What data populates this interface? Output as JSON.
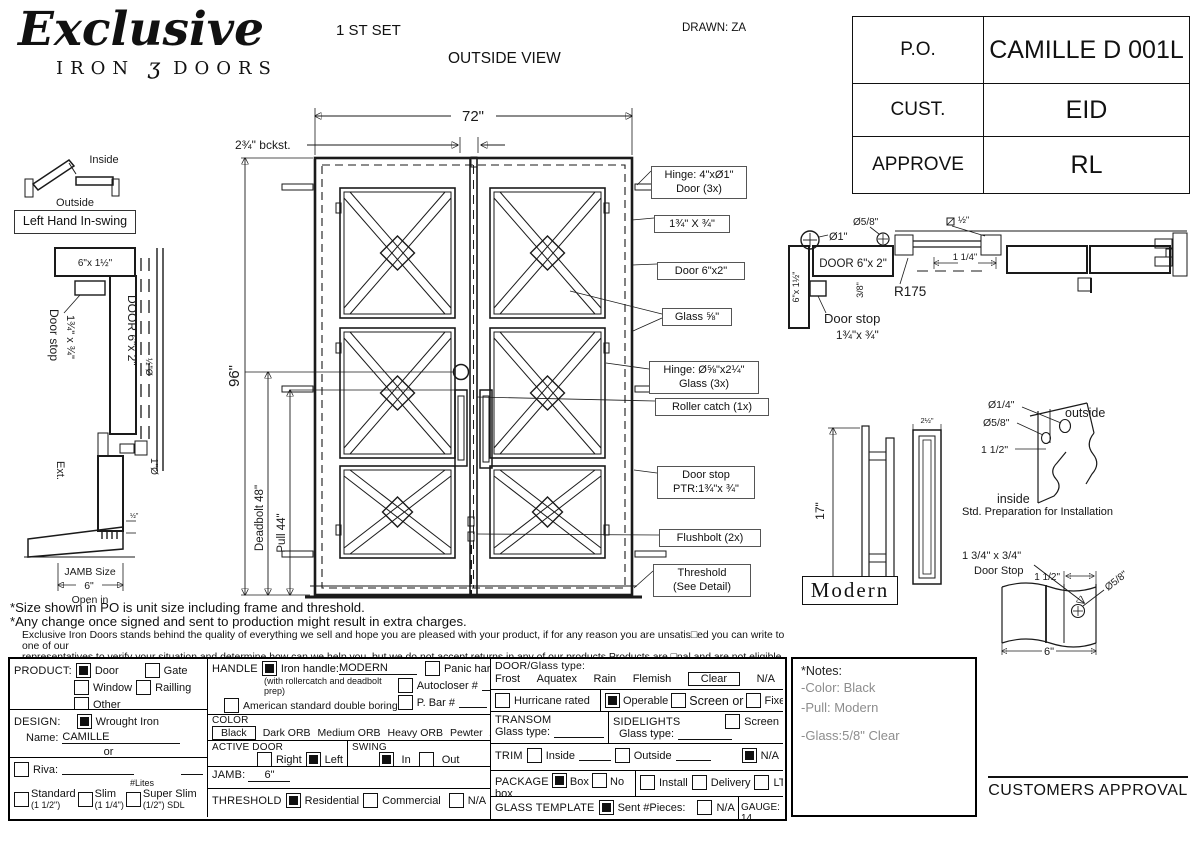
{
  "header": {
    "logo_script": "Exclusive",
    "logo_iron": "IRON",
    "logo_glyph": "ʒ",
    "logo_doors": "DOORS",
    "set_label": "1 ST SET",
    "view_label": "OUTSIDE VIEW",
    "drawn_label": "DRAWN: ZA"
  },
  "approval_table": {
    "rows": [
      {
        "label": "P.O.",
        "value": "CAMILLE D 001L"
      },
      {
        "label": "CUST.",
        "value": "EID"
      },
      {
        "label": "APPROVE",
        "value": "RL"
      }
    ]
  },
  "swing": {
    "inside": "Inside",
    "outside": "Outside",
    "label": "Left Hand In-swing"
  },
  "jamb_detail": {
    "header_dim": "6\"x 1½\"",
    "door_stop_1": "Door stop",
    "door_stop_2": "1¾\" x ¾\"",
    "door_label": "DOOR 6\"x 2\"",
    "half_dia": "½\"Ø",
    "one_dia": "1\"Ø",
    "half_tick": "½\"",
    "ext": "Ext.",
    "jamb_size": "JAMB Size",
    "jamb_width": "6\"",
    "open_in": "Open in"
  },
  "door": {
    "width_dim": "72\"",
    "backset_dim": "2¾\" bckst.",
    "height_dim": "96\"",
    "deadbolt_dim": "Deadbolt 48\"",
    "pull_dim": "Pull 44\"",
    "callouts": [
      {
        "l1": "Hinge: 4\"xØ1\"",
        "l2": "Door (3x)"
      },
      {
        "l1": "1¾\" X ¾\""
      },
      {
        "l1": "Door 6\"x2\""
      },
      {
        "l1": "Glass ⅝\""
      },
      {
        "l1": "Hinge: Ø⅝\"x2¼\"",
        "l2": "Glass (3x)"
      },
      {
        "l1": "Roller catch  (1x)"
      },
      {
        "l1": "Door stop",
        "l2": "PTR:1¾\"x ¾\""
      },
      {
        "l1": "Flushbolt (2x)"
      },
      {
        "l1": "Threshold",
        "l2": "(See Detail)"
      }
    ]
  },
  "head_section": {
    "dia_one": "Ø1\"",
    "dia_58": "Ø5/8\"",
    "sq_half": "½\"",
    "door_label": "DOOR 6\"x 2\"",
    "jamb_dim": "6\"x 1½\"",
    "dim_38": "3/8\"",
    "dim_114": "1 1/4\"",
    "radius": "R175",
    "door_stop_1": "Door stop",
    "door_stop_2": "1¾\"x ¾\""
  },
  "handle_detail": {
    "height_dim": "17\"",
    "width_dim": "2½\"",
    "style": "Modern"
  },
  "corner_detail": {
    "dia_14": "Ø1/4\"",
    "dia_58": "Ø5/8\"",
    "offset": "1 1/2\"",
    "outside": "outside",
    "inside": "inside",
    "caption": "Std. Preparation for Installation"
  },
  "stop_detail": {
    "title_1": "1 3/4\" x 3/4\"",
    "title_2": "Door Stop",
    "dim_top": "1 1/2\"",
    "dia": "Ø5/8\"",
    "dim_bottom": "6\""
  },
  "disclaimer": {
    "line1": "*Size shown in PO is unit size including frame and threshold.",
    "line2": "*Any change once signed and sent to production might result in extra charges.",
    "line3": "Exclusive Iron Doors stands behind the quality of everything we sell and hope you are pleased with your product, if for any reason you are unsatis□ed you can write to one of our",
    "line4": "representatives to verify your situation and determine how can we help you, but we do not accept returns in any of our products.Products are □nal and are not eligible for returns, changes",
    "line5": "or alterations.By signing you agree to our terms and conditions, delivery pdf and forms of payment. *Doors measurements do not include the gaps between jambs"
  },
  "form": {
    "product": {
      "label": "PRODUCT:",
      "door": {
        "label": "Door",
        "checked": "true"
      },
      "gate": {
        "label": "Gate",
        "checked": "false"
      },
      "window": {
        "label": "Window",
        "checked": "false"
      },
      "railing": {
        "label": "Railling",
        "checked": "false"
      },
      "other": {
        "label": "Other",
        "checked": "false"
      }
    },
    "design": {
      "label": "DESIGN:",
      "wrought": {
        "label": "Wrought Iron",
        "checked": "true"
      },
      "name_label": "Name:",
      "name_value": "CAMILLE",
      "or_label": "or"
    },
    "riva": {
      "label": "Riva:",
      "checked": "false",
      "lites": "#Lites",
      "standard": {
        "label": "Standard",
        "sub": "(1 1/2\")",
        "checked": "false"
      },
      "slim": {
        "label": "Slim",
        "sub": "(1 1/4\")",
        "checked": "false"
      },
      "super_slim": {
        "label": "Super Slim",
        "sub": "(1/2\") SDL",
        "checked": "false"
      }
    },
    "handle": {
      "label": "HANDLE",
      "iron": {
        "label": "Iron handle:",
        "value": "MODERN",
        "sub": "(with rollercatch and deadbolt prep)",
        "checked": "true"
      },
      "american": {
        "label": "American standard double boring",
        "checked": "false"
      },
      "other": {
        "label": "Other:",
        "checked": "false"
      },
      "panic": {
        "label": "Panic hardware",
        "checked": "false"
      },
      "autocloser": {
        "label": "Autocloser #",
        "checked": "false"
      },
      "pbar": {
        "label": "P. Bar #",
        "checked": "false"
      }
    },
    "color": {
      "label": "COLOR",
      "selected": "Black",
      "opt1": "Dark ORB",
      "opt2": "Medium ORB",
      "opt3": "Heavy ORB",
      "opt4": "Pewter",
      "opt5": "Antique gold"
    },
    "active_door": {
      "label": "ACTIVE DOOR",
      "right": {
        "label": "Right",
        "checked": "false"
      },
      "left": {
        "label": "Left",
        "checked": "true"
      }
    },
    "swing": {
      "label": "SWING",
      "in": {
        "label": "In",
        "checked": "true"
      },
      "out": {
        "label": "Out",
        "checked": "false"
      }
    },
    "jamb": {
      "label": "JAMB:",
      "value": "6\""
    },
    "threshold": {
      "label": "THRESHOLD",
      "residential": {
        "label": "Residential",
        "checked": "true"
      },
      "commercial": {
        "label": "Commercial",
        "checked": "false"
      },
      "na": {
        "label": "N/A",
        "checked": "false"
      }
    },
    "door_glass": {
      "label": "DOOR/Glass type:",
      "opt1": "Frost",
      "opt2": "Aquatex",
      "opt3": "Rain",
      "opt4": "Flemish",
      "selected": "Clear",
      "opt6": "N/A"
    },
    "hurricane": {
      "label": "Hurricane rated",
      "checked": "false"
    },
    "operable": {
      "label": "Operable",
      "checked": "true"
    },
    "screen_or": {
      "label": "Screen or",
      "checked": "false"
    },
    "fixed": {
      "label": "Fixed",
      "checked": "false"
    },
    "transom": {
      "label": "TRANSOM",
      "glass_label": "Glass type:"
    },
    "sidelights": {
      "label": "SIDELIGHTS",
      "glass_label": "Glass type:",
      "screen": {
        "label": "Screen",
        "checked": "false"
      }
    },
    "trim": {
      "label": "TRIM",
      "inside": {
        "label": "Inside",
        "checked": "false"
      },
      "outside": {
        "label": "Outside",
        "checked": "false"
      },
      "na": {
        "label": "N/A",
        "checked": "true"
      }
    },
    "package": {
      "label": "PACKAGE",
      "box": {
        "label": "Box",
        "checked": "true"
      },
      "no_box": {
        "label": "No box",
        "checked": "false"
      },
      "install": {
        "label": "Install",
        "checked": "false"
      },
      "delivery": {
        "label": "Delivery",
        "checked": "false"
      },
      "ltl": {
        "label": "LTL",
        "checked": "false"
      }
    },
    "glass_template": {
      "label": "GLASS TEMPLATE",
      "sent": {
        "label": "Sent #Pieces:",
        "checked": "true"
      },
      "na": {
        "label": "N/A",
        "checked": "false"
      }
    },
    "gauge": {
      "label": "GAUGE: 14"
    }
  },
  "notes": {
    "title": "*Notes:",
    "line1": "-Color: Black",
    "line2": "-Pull: Modern",
    "line3": "-Glass:5/8\"   Clear"
  },
  "approval": {
    "label": "CUSTOMERS APPROVAL"
  }
}
